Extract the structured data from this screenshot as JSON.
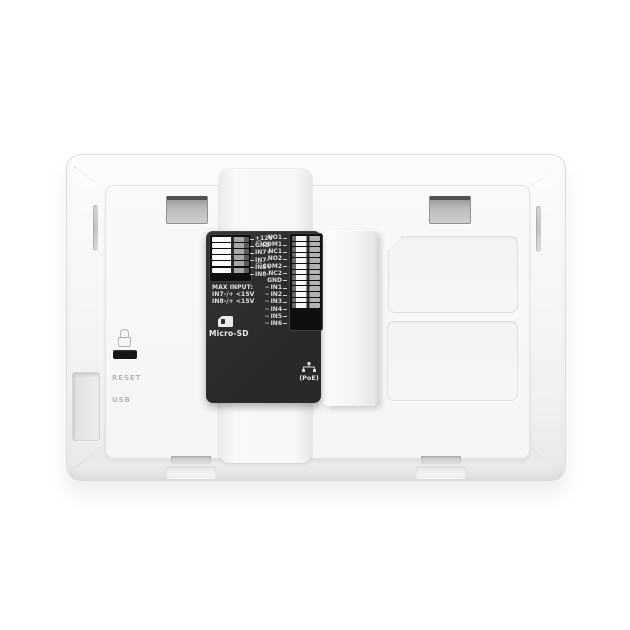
{
  "device": {
    "type": "intercom-monitor-back-panel"
  },
  "module": {
    "power_block": {
      "terminals": [
        "+12V",
        "GND",
        "IN7+",
        "IN7-",
        "IN8+",
        "IN8-"
      ]
    },
    "io_block": {
      "terminals": [
        {
          "label": "NO1",
          "symbol": ""
        },
        {
          "label": "COM1",
          "symbol": "⌒"
        },
        {
          "label": "NC1",
          "symbol": ""
        },
        {
          "label": "NO2",
          "symbol": ""
        },
        {
          "label": "COM2",
          "symbol": "⌒"
        },
        {
          "label": "NC2",
          "symbol": ""
        },
        {
          "label": "GND",
          "symbol": ""
        },
        {
          "label": "IN1",
          "symbol": "~"
        },
        {
          "label": "IN2",
          "symbol": "~"
        },
        {
          "label": "IN3",
          "symbol": "~"
        },
        {
          "label": "IN4",
          "symbol": "~"
        },
        {
          "label": "IN5",
          "symbol": "~"
        },
        {
          "label": "IN6",
          "symbol": "~"
        }
      ]
    },
    "max_input": {
      "title": "MAX INPUT:",
      "lines": [
        "IN7-/+ <15V",
        "IN8-/+ <15V"
      ]
    },
    "micro_sd_label": "Micro-SD",
    "poe_label": "(PoE)"
  },
  "panel": {
    "reset_label": "RESET",
    "usb_label": "USB"
  },
  "icons": {
    "lock": "lock-icon",
    "micro_sd": "sd-card-icon",
    "poe": "ethernet-icon"
  },
  "colors": {
    "background": "#ffffff",
    "shell": "#f3f4f5",
    "inner_panel": "#f6f7f8",
    "module_bg": "#2c2d2f",
    "module_text": "#e2e3e4",
    "panel_text": "#b4b6b8",
    "slot_dark": "#4f5052"
  }
}
